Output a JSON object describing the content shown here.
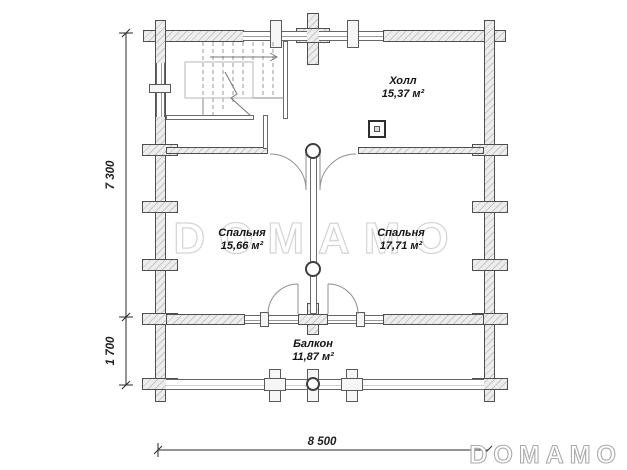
{
  "plan": {
    "rooms": [
      {
        "name": "Холл",
        "area": "15,37 м²"
      },
      {
        "name": "Спальня",
        "area": "15,66 м²"
      },
      {
        "name": "Спальня",
        "area": "17,71 м²"
      },
      {
        "name": "Балкон",
        "area": "11,87 м²"
      }
    ],
    "dimensions": {
      "depth_total": "7 300",
      "balcony_depth": "1 700",
      "width_total": "8 500"
    }
  },
  "branding": {
    "watermark": "DOMAMO",
    "logo": "DOMAMO"
  },
  "colors": {
    "wall_fill": "#ededed",
    "wall_outline": "#4f4f4f",
    "thin_line": "#8a8a8a",
    "label_text": "#141414",
    "watermark_outline": "#d4d4d4"
  }
}
